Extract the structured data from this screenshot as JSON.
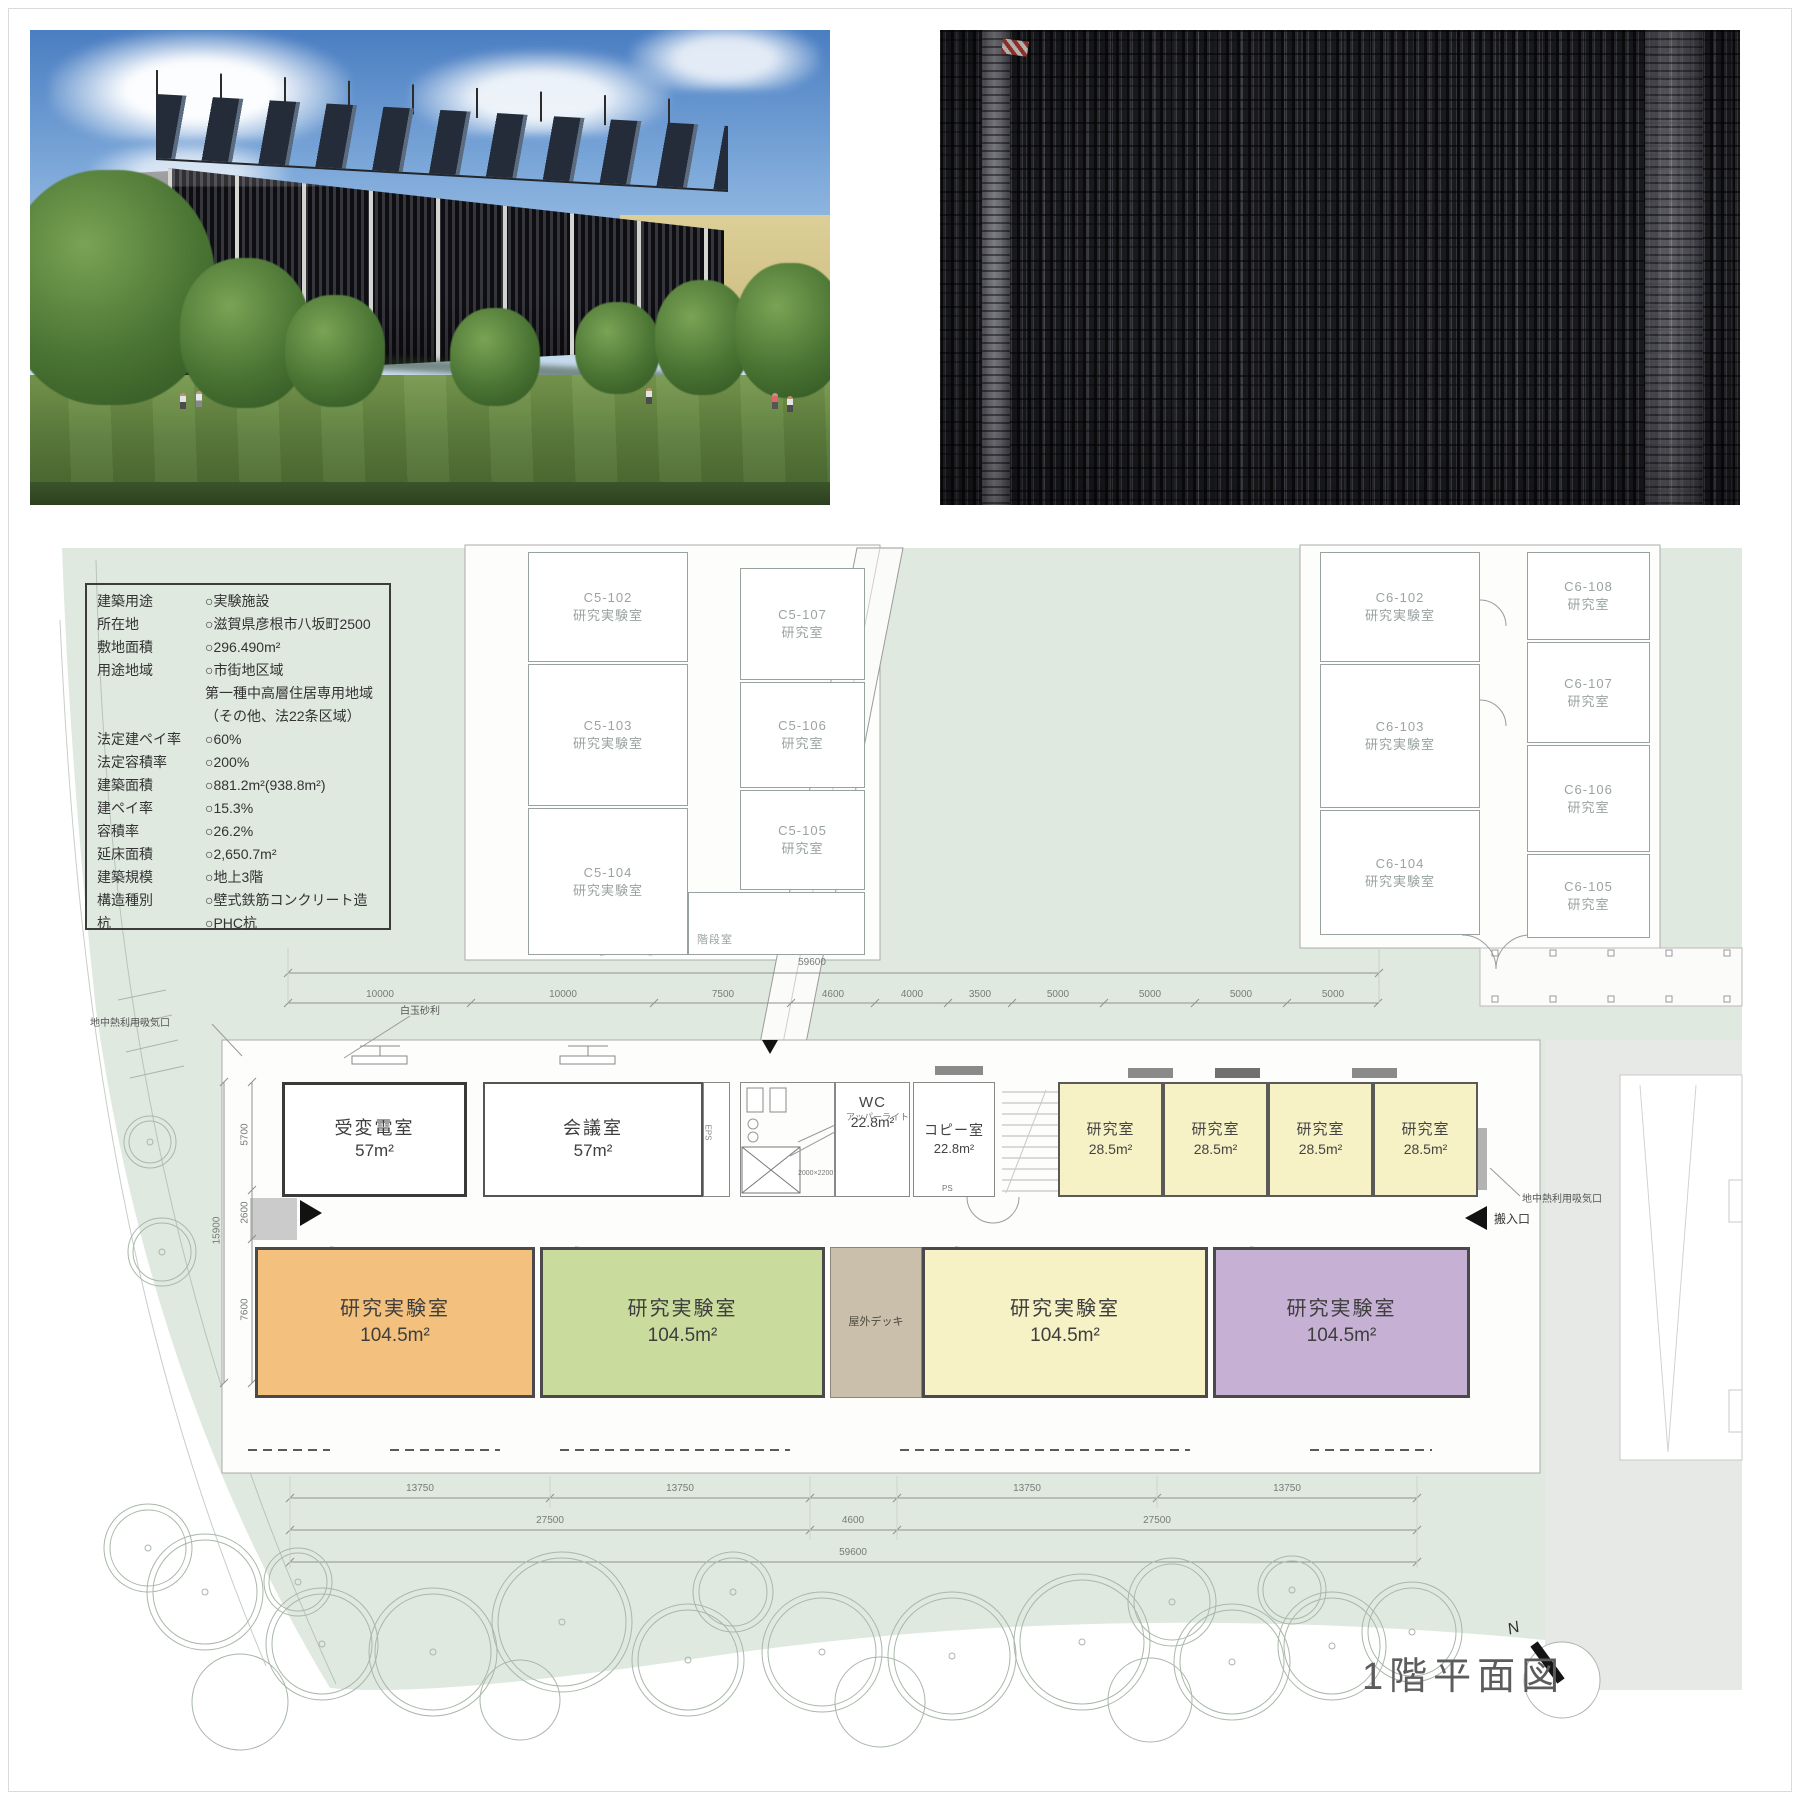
{
  "title": "1階平面図",
  "colors": {
    "site_green": "#dfe9e0",
    "road_gray": "#e7e9e6",
    "room_orange": "#f3c17d",
    "room_green": "#c9dc9d",
    "room_yellow_large": "#f6f2c5",
    "room_purple": "#c6b0d4",
    "room_yellow_small": "#f6f2c6",
    "deck_tan": "#c9bfab"
  },
  "info_table": {
    "rows": [
      {
        "label": "建築用途",
        "value": "○実験施設"
      },
      {
        "label": "所在地",
        "value": "○滋賀県彦根市八坂町2500"
      },
      {
        "label": "敷地面積",
        "value": "○296.490m²"
      },
      {
        "label": "用途地域",
        "value": "○市街地区域"
      },
      {
        "label": "",
        "value": "第一種中高層住居専用地域"
      },
      {
        "label": "",
        "value": "（その他、法22条区域）"
      },
      {
        "label": "法定建ペイ率",
        "value": "○60%"
      },
      {
        "label": "法定容積率",
        "value": "○200%"
      },
      {
        "label": "建築面積",
        "value": "○881.2m²(938.8m²)"
      },
      {
        "label": "建ペイ率",
        "value": "○15.3%"
      },
      {
        "label": "容積率",
        "value": "○26.2%"
      },
      {
        "label": "延床面積",
        "value": "○2,650.7m²"
      },
      {
        "label": "建築規模",
        "value": "○地上3階"
      },
      {
        "label": "構造種別",
        "value": "○壁式鉄筋コンクリート造"
      },
      {
        "label": "杭",
        "value": "○PHC杭"
      }
    ]
  },
  "rooms": {
    "c5": [
      {
        "code": "C5-102",
        "type": "研究実験室"
      },
      {
        "code": "C5-103",
        "type": "研究実験室"
      },
      {
        "code": "C5-104",
        "type": "研究実験室"
      },
      {
        "code": "C5-107",
        "type": "研究室"
      },
      {
        "code": "C5-106",
        "type": "研究室"
      },
      {
        "code": "C5-105",
        "type": "研究室"
      }
    ],
    "c5_stair": "階段室",
    "c6": [
      {
        "code": "C6-102",
        "type": "研究実験室"
      },
      {
        "code": "C6-103",
        "type": "研究実験室"
      },
      {
        "code": "C6-104",
        "type": "研究実験室"
      },
      {
        "code": "C6-108",
        "type": "研究室"
      },
      {
        "code": "C6-107",
        "type": "研究室"
      },
      {
        "code": "C6-106",
        "type": "研究室"
      },
      {
        "code": "C6-105",
        "type": "研究室"
      }
    ],
    "north_wing": [
      {
        "name": "受変電室",
        "area": "57m²"
      },
      {
        "name": "会議室",
        "area": "57m²"
      },
      {
        "name": "WC",
        "area": "22.8m²"
      },
      {
        "name": "コピー室",
        "area": "22.8m²"
      },
      {
        "name": "研究室",
        "area": "28.5m²"
      },
      {
        "name": "研究室",
        "area": "28.5m²"
      },
      {
        "name": "研究室",
        "area": "28.5m²"
      },
      {
        "name": "研究室",
        "area": "28.5m²"
      }
    ],
    "south_wing": [
      {
        "name": "研究実験室",
        "area": "104.5m²"
      },
      {
        "name": "研究実験室",
        "area": "104.5m²"
      },
      {
        "name": "研究実験室",
        "area": "104.5m²"
      },
      {
        "name": "研究実験室",
        "area": "104.5m²"
      }
    ],
    "deck": "屋外デッキ"
  },
  "labels": {
    "gravel": "白玉砂利",
    "upper_light": "アッパーライト",
    "geo_left": "地中熱利用吸気口",
    "geo_right": "地中熱利用吸気口",
    "carry_in": "搬入口",
    "eps": "EPS",
    "ps": "PS",
    "elevator_size": "2000×2200",
    "north": "N"
  },
  "dims": {
    "top_overall": "59600",
    "top_segments": [
      "10000",
      "10000",
      "7500",
      "4600",
      "4000",
      "3500",
      "5000",
      "5000",
      "5000",
      "5000"
    ],
    "left": [
      "5700",
      "2600",
      "7600",
      "15900"
    ],
    "bottom_row1": [
      "13750",
      "13750",
      "13750",
      "13750"
    ],
    "bottom_row2": [
      "27500",
      "4600",
      "27500"
    ],
    "bottom_overall": "59600"
  }
}
